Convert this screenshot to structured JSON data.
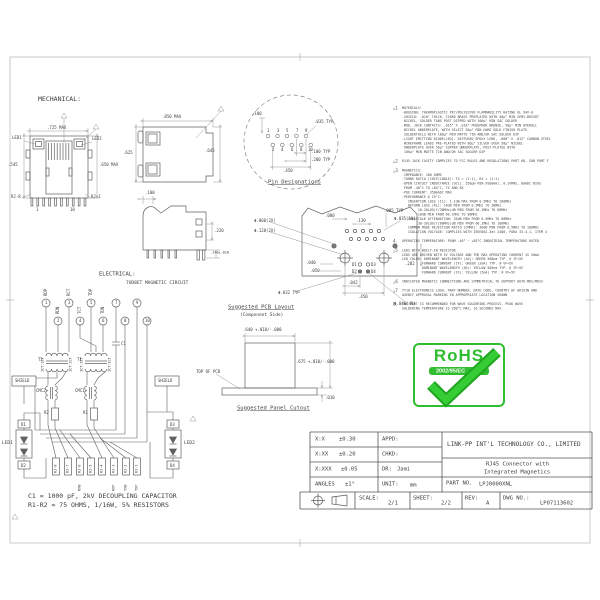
{
  "mech": {
    "title": "MECHANICAL:",
    "front": {
      "dim_top": ".725 MAX",
      "dim_left": ".545",
      "dim_right": ".650 MAX",
      "led1": "LED1",
      "led2": "LED2",
      "rj8": "RJ-8",
      "rj1": "RJ-1",
      "pin_first": "1",
      "pin_last": "10"
    },
    "top": {
      "dim_top": ".850 MAX",
      "dim_left": ".625",
      "dim_right": ".645"
    },
    "side": {
      "dim_top": ".100",
      "dim_r1": ".220",
      "dim_r2": ".140±.010"
    }
  },
  "pins": {
    "title": "Pin Designations",
    "top": [
      "1",
      "3",
      "5",
      "7",
      "9"
    ],
    "bottom": [
      "2",
      "4",
      "6",
      "8",
      "10"
    ],
    "dim_100": ".100",
    "dim_035": ".035 TYP",
    "dim_100t": ".100 TYP",
    "dim_200t": ".200 TYP",
    "dim_450": ".450"
  },
  "elec": {
    "title": "ELECTRICAL:",
    "subtitle": "7UD8ET MAGNETIC CIRCUIT",
    "pin_nums": [
      "1",
      "2",
      "3",
      "4",
      "5",
      "6",
      "7",
      "8",
      "9",
      "10"
    ],
    "pin_labels": [
      "RDP",
      "RDN",
      "RCT",
      "TCT",
      "TDP",
      "TDN"
    ],
    "t1": "T1",
    "t2": "T2",
    "ratio": "1CT:1CT",
    "cmc1": "CMC1",
    "cmc2": "CMC2",
    "r1": "R1",
    "r2": "R2",
    "c1": "C1",
    "shield": "SHIELD",
    "d1": "D1",
    "d2": "D2",
    "d3": "D3",
    "d4": "D4",
    "led1": "LED1",
    "led2": "LED2",
    "rj": [
      "RJ-8",
      "RJ-7",
      "RJ-6",
      "RJ-5",
      "RJ-4",
      "RJ-3",
      "RJ-2",
      "RJ-1"
    ],
    "sig": [
      "RXN",
      "RXP",
      "TXN",
      "TXP"
    ],
    "cap_note": "C1 = 1000 pF, 2kV DECOUPLING CAPACITOR",
    "res_note": "R1-R2 = 75 OHMS, 1/16W, 5% RESISTORS"
  },
  "pcb": {
    "title": "Suggested PCB Layout",
    "subtitle": "(Component Side)",
    "d1": "D1",
    "d2": "D2",
    "d3": "D3",
    "d4": "D4",
    "dims": {
      "phi060": "Φ.060(2X)",
      "phi128": "Φ.128(2X)",
      "d080": ".080",
      "d130": ".130",
      "d085": ".085 TYP",
      "phi035": "Φ.035(10)",
      "d040": ".040",
      "d050": ".050",
      "phi032": "Φ.032 TYP",
      "d042": ".042",
      "d450": ".450",
      "phi040": "Φ.040(4X)",
      "d202": ".202"
    }
  },
  "panel": {
    "title": "Suggested Panel Cutout",
    "top_of_pcb": "TOP OF PCB",
    "dim_w": ".640 +.010/-.000",
    "dim_h": ".675 +.010/-.000",
    "dim_t": ".010"
  },
  "notes": [
    {
      "m": "△1",
      "t": "MATERIALS:\n-HOUSING: THERMOPLASTIC PET/POLYESTER FLAMMABILITY RATING UL 94V-0\n-SHIELD: .010\" THICK, C2680 BRASS PREPLATED WITH 50μ\" MIN SEMI-BRIGHT\n NICKEL, SOLDER TABS POST DIPPED WITH 100μ\" MIN SAC SOLDER\n-MOD. JACK CONTACTS: .015\" X .018\" PHOSPHOR BRONZE, 50μ\" MIN OVERALL\n NICKEL UNDERPLATE, WITH SELECT 30μ\" MIN HARD GOLD FINISH PLATE,\n SOLDERTAILS WITH 100μ\" MIN MATTE TIN AND/OR SAC SOLDER DIP\n-LIGHT EMITTING DIODE(LED): DIFFUSED EPOXY LENS, .008\" X .012\" CARBON STEEL\n WIREFRAME LEADS PRE-PLATED WITH 80μ\" SILVER OVER 50μ\" NICKEL\n UNDERPLATE OVER 50μ\" COPPER UNDERPLATE, POST-PLATED WITH\n 100μ\" MIN MATTE TIN AND/OR SAC SOLDER DIP"
    },
    {
      "m": "△2",
      "t": "RJ45 JACK CAVITY COMPLIES TO FCC RULES AND REGULATIONS PART 68, SUB PART F"
    },
    {
      "m": "△3",
      "t": "MAGNETICS:\n-IMPEDANCE: 100 OHMS\n-TURNS RATIO (CHIP/CABLE): TX = (1:1), RX = (1:1)\n-OPEN CIRCUIT INDUCTANCE (OCL): 350μH MIN @100kHz, 0.1VRMS, 8mADC BIAS\n FROM -40°C TO +85°C, TX AND RX\n-POE CURRENT: 350mADC MAX\n-PERFORMANCE @ 25°C:\n   INSERTION LOSS (IL): 1.1dB MAX FROM 0.5MHz TO 100MHz\n   RETURN LOSS (RL): 16dB MIN FROM 0.5MHz TO 30MHz\n        16-20LOG(f/30MHz)dB MIN FROM 30.1MHz TO 60MHz\n        10dB MIN FROM 60.1MHz TO 80MHz\n   CROSSTALK ATTENUATION: 35dB MIN FROM 0.5MHz TO 60MHz\n        30-20LOG(f/60MHz)dB MIN FROM 60.1MHz TO 100MHz\n   COMMON MODE REJECTION RATIO (CMRR): 30dB MIN FROM 0.5MHz TO 100MHz\n   ISOLATION VOLTAGE: COMPLIES WITH IEEE802.3at 2400, PARA 33.4.1, ITEM 4"
    },
    {
      "m": "4.",
      "t": "OPERATING TEMPERATURE: FROM -40° ~ +85°C INDUSTRIAL TEMPERATURE RATED"
    },
    {
      "m": "△5",
      "t": "LEDS WITH BUILT-IN RESISTOR\nLEDS ARE DRIVEN WITH 5V VOLTAGE AND THE MAX OPERATING CURRENT IS 20mA\nLED COLOR: DOMINANT WAVELENGTH (λD): GREEN 568nm TYP. @ IF=5V\n          FORWARD CURRENT (IF): GREEN (2mA) TYP. @ VF=5V\n          DOMINANT WAVELENGTH (λD): YELLOW 585nm TYP. @ IF=5V\n          FORWARD CURRENT (IF): YELLOW (5mA) TYP. @ VF=5V"
    },
    {
      "m": "△6",
      "t": "INDICATED MAGNETIC CONNECTIONS ARE SYMMETRICAL TO SUPPORT AUTO-MDI/MDIX"
    },
    {
      "m": "△7",
      "t": "TY10 ELECTRONICS LOGO, PART NUMBER, DATE CODE, COUNTRY OF ORIGIN AND\nAGENCY APPROVAL MARKING IN APPROPRIATE LOCATION SHOWN"
    },
    {
      "m": "8.",
      "t": "THE PART IS RECOMMENDED FOR WAVE SOLDERING PROCESS, PEAK WAVE\nSOLDERING TEMPERATURE IS 260°C MAX, 10 SECONDS MAX."
    }
  ],
  "rohs": {
    "title": "RoHS",
    "directive": "2002/95/EC"
  },
  "tb": {
    "company": "LINK-PP INT'L TECHNOLOGY CO., LIMITED",
    "product1": "RJ45 Connector with",
    "product2": "Integrated Magnetics",
    "tol": [
      {
        "k": "X:X",
        "v": "±0.30"
      },
      {
        "k": "X:XX",
        "v": "±0.20"
      },
      {
        "k": "X:XXX",
        "v": "±0.05"
      },
      {
        "k": "ANGLES",
        "v": "±1°"
      }
    ],
    "appd": "APPD:",
    "chkd": "CHKD:",
    "dr": "DR:",
    "dr_v": "Jami",
    "unit": "UNIT:",
    "unit_v": "mm",
    "part_label": "PART NO.",
    "part_value": "LPJ0000XNL",
    "scale": "SCALE:",
    "scale_v": "2/1",
    "sheet": "SHEET:",
    "sheet_v": "2/2",
    "rev": "REV:",
    "rev_v": "A",
    "dwg": "DWG NO.:",
    "dwg_v": "LP07113602"
  }
}
